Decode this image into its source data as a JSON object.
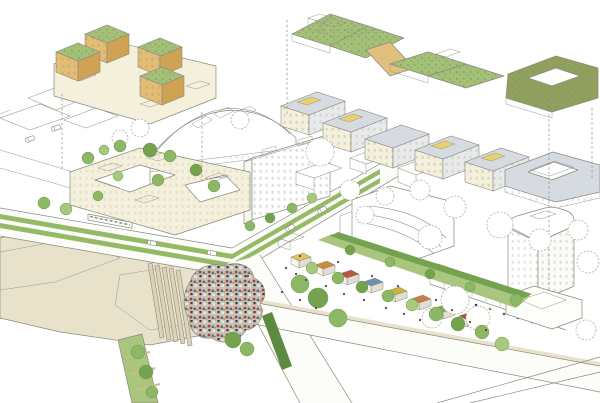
{
  "colors": {
    "paper": "#ffffff",
    "ink": "#8a8a80",
    "ink_soft": "#aeaea4",
    "beige": "#e9e2cb",
    "beige_soft": "#f4efe0",
    "road": "#fcfcf9",
    "grass": "#a9c57e",
    "tram_grass": "#95ba66",
    "tree": "#8cb765",
    "tree_dark": "#74a24e",
    "tree_light": "#a6c87f",
    "hedge": "#5d8a43",
    "roof_green": "#a2c077",
    "roof_olive": "#8fa05f",
    "cream": "#f5f0dc",
    "tan": "#cfa254",
    "tan_light": "#e3bd74",
    "tan_ramp": "#e0c07c",
    "yellow": "#e9cf6e",
    "gray_roof": "#d5dbe0",
    "gray_face": "#e8eaea",
    "glass": "#cfe2c9",
    "pool": "#cde1e8",
    "pond": "#eef3f2",
    "canopy_base": "#c9c3b6",
    "canopy_red": "#9f4439",
    "canopy_blue": "#4e6e92",
    "canopy_navy": "#2f3d55",
    "canopy_light": "#e9e5da",
    "canopy_orange": "#c07840",
    "tram_body": "#fbfbf8",
    "figure": "#4a4a44",
    "stall_colors": [
      "#e5c35c",
      "#cf8a3e",
      "#b85643",
      "#6d8fae",
      "#c9b23f",
      "#c77b47",
      "#87a457",
      "#b0563f"
    ],
    "crowd_colors": [
      "#9f4439",
      "#4e6e92",
      "#2f3d55",
      "#c07840"
    ]
  },
  "trees": [
    {
      "x": 88,
      "y": 158,
      "r": 6,
      "tone": "tree"
    },
    {
      "x": 104,
      "y": 150,
      "r": 5,
      "tone": "tree_light"
    },
    {
      "x": 120,
      "y": 146,
      "r": 6,
      "tone": "tree"
    },
    {
      "x": 150,
      "y": 150,
      "r": 7,
      "tone": "tree_dark"
    },
    {
      "x": 170,
      "y": 156,
      "r": 6,
      "tone": "tree"
    },
    {
      "x": 118,
      "y": 176,
      "r": 5,
      "tone": "tree_light"
    },
    {
      "x": 158,
      "y": 180,
      "r": 6,
      "tone": "tree"
    },
    {
      "x": 196,
      "y": 170,
      "r": 6,
      "tone": "tree_dark"
    },
    {
      "x": 214,
      "y": 186,
      "r": 6,
      "tone": "tree"
    },
    {
      "x": 98,
      "y": 196,
      "r": 5,
      "tone": "tree"
    },
    {
      "x": 44,
      "y": 203,
      "r": 6,
      "tone": "tree"
    },
    {
      "x": 66,
      "y": 209,
      "r": 6,
      "tone": "tree_light"
    },
    {
      "x": 250,
      "y": 226,
      "r": 5,
      "tone": "tree"
    },
    {
      "x": 270,
      "y": 218,
      "r": 5,
      "tone": "tree_dark"
    },
    {
      "x": 292,
      "y": 208,
      "r": 5,
      "tone": "tree"
    },
    {
      "x": 312,
      "y": 198,
      "r": 5,
      "tone": "tree_light"
    },
    {
      "x": 138,
      "y": 352,
      "r": 7,
      "tone": "tree"
    },
    {
      "x": 146,
      "y": 372,
      "r": 7,
      "tone": "tree_dark"
    },
    {
      "x": 152,
      "y": 392,
      "r": 6,
      "tone": "tree"
    },
    {
      "x": 233,
      "y": 340,
      "r": 8,
      "tone": "tree_dark"
    },
    {
      "x": 247,
      "y": 349,
      "r": 7,
      "tone": "tree"
    },
    {
      "x": 300,
      "y": 284,
      "r": 9,
      "tone": "tree"
    },
    {
      "x": 318,
      "y": 298,
      "r": 10,
      "tone": "tree_dark"
    },
    {
      "x": 338,
      "y": 318,
      "r": 9,
      "tone": "tree"
    },
    {
      "x": 312,
      "y": 268,
      "r": 6,
      "tone": "tree_light"
    },
    {
      "x": 338,
      "y": 278,
      "r": 6,
      "tone": "tree"
    },
    {
      "x": 362,
      "y": 287,
      "r": 6,
      "tone": "tree_dark"
    },
    {
      "x": 388,
      "y": 296,
      "r": 6,
      "tone": "tree"
    },
    {
      "x": 412,
      "y": 305,
      "r": 6,
      "tone": "tree_light"
    },
    {
      "x": 436,
      "y": 314,
      "r": 7,
      "tone": "tree"
    },
    {
      "x": 458,
      "y": 324,
      "r": 7,
      "tone": "tree_dark"
    },
    {
      "x": 482,
      "y": 332,
      "r": 7,
      "tone": "tree"
    },
    {
      "x": 350,
      "y": 250,
      "r": 5,
      "tone": "tree_dark"
    },
    {
      "x": 390,
      "y": 262,
      "r": 5,
      "tone": "tree"
    },
    {
      "x": 430,
      "y": 274,
      "r": 5,
      "tone": "tree_dark"
    },
    {
      "x": 470,
      "y": 287,
      "r": 5,
      "tone": "tree"
    },
    {
      "x": 502,
      "y": 344,
      "r": 7,
      "tone": "tree_light"
    },
    {
      "x": 516,
      "y": 300,
      "r": 6,
      "tone": "tree"
    }
  ],
  "sketch_trees": [
    {
      "x": 140,
      "y": 128,
      "r": 9
    },
    {
      "x": 120,
      "y": 138,
      "r": 8
    },
    {
      "x": 240,
      "y": 120,
      "r": 9
    },
    {
      "x": 320,
      "y": 152,
      "r": 14
    },
    {
      "x": 350,
      "y": 190,
      "r": 10
    },
    {
      "x": 385,
      "y": 196,
      "r": 9
    },
    {
      "x": 420,
      "y": 190,
      "r": 10
    },
    {
      "x": 455,
      "y": 207,
      "r": 11
    },
    {
      "x": 365,
      "y": 215,
      "r": 9
    },
    {
      "x": 430,
      "y": 237,
      "r": 12
    },
    {
      "x": 455,
      "y": 300,
      "r": 14
    },
    {
      "x": 432,
      "y": 318,
      "r": 10
    },
    {
      "x": 478,
      "y": 318,
      "r": 12
    },
    {
      "x": 500,
      "y": 225,
      "r": 13
    },
    {
      "x": 540,
      "y": 240,
      "r": 11
    },
    {
      "x": 578,
      "y": 230,
      "r": 10
    },
    {
      "x": 588,
      "y": 262,
      "r": 11
    },
    {
      "x": 586,
      "y": 330,
      "r": 10
    }
  ],
  "leader_lines": [
    {
      "x1": 62,
      "y1": 94,
      "x2": 62,
      "y2": 170
    },
    {
      "x1": 202,
      "y1": 112,
      "x2": 202,
      "y2": 182
    },
    {
      "x1": 287,
      "y1": 20,
      "x2": 287,
      "y2": 114
    },
    {
      "x1": 549,
      "y1": 100,
      "x2": 549,
      "y2": 290
    },
    {
      "x1": 592,
      "y1": 108,
      "x2": 592,
      "y2": 180
    }
  ],
  "garden_strips": [
    "148,264 152,263 164,337 160,338",
    "155,266 159,265 171,339 167,340",
    "162,268 166,267 178,341 174,342",
    "169,269 173,268 185,343 181,344",
    "176,271 180,270 192,345 188,346"
  ],
  "median_stripes": [
    {
      "x1": 126,
      "y1": 358,
      "x2": 150,
      "y2": 352
    },
    {
      "x1": 131,
      "y1": 374,
      "x2": 155,
      "y2": 368
    },
    {
      "x1": 136,
      "y1": 390,
      "x2": 160,
      "y2": 384
    }
  ],
  "stalls": [
    {
      "x": 300,
      "y": 258,
      "c": 0
    },
    {
      "x": 324,
      "y": 266,
      "c": 1
    },
    {
      "x": 348,
      "y": 275,
      "c": 2
    },
    {
      "x": 372,
      "y": 283,
      "c": 3
    },
    {
      "x": 396,
      "y": 292,
      "c": 4
    },
    {
      "x": 420,
      "y": 300,
      "c": 5
    },
    {
      "x": 444,
      "y": 309,
      "c": 6
    },
    {
      "x": 468,
      "y": 317,
      "c": 7
    }
  ],
  "vehicles": {
    "tram": {
      "x": 88,
      "y": 214,
      "len": 44,
      "slope": 0.19,
      "h": 6
    },
    "cars": [
      {
        "x": 152,
        "y": 243,
        "a": 10
      },
      {
        "x": 212,
        "y": 253,
        "a": 10
      },
      {
        "x": 290,
        "y": 228,
        "a": -30
      },
      {
        "x": 322,
        "y": 210,
        "a": -30
      },
      {
        "x": 30,
        "y": 139,
        "a": -20
      },
      {
        "x": 56,
        "y": 128,
        "a": -20
      }
    ]
  },
  "figures": [
    [
      286,
      268
    ],
    [
      296,
      274
    ],
    [
      306,
      280
    ],
    [
      326,
      286
    ],
    [
      344,
      294
    ],
    [
      364,
      300
    ],
    [
      386,
      308
    ],
    [
      404,
      314
    ],
    [
      420,
      320
    ],
    [
      300,
      256
    ],
    [
      338,
      262
    ],
    [
      372,
      276
    ],
    [
      398,
      286
    ],
    [
      436,
      300
    ],
    [
      452,
      310
    ],
    [
      470,
      322
    ],
    [
      486,
      330
    ],
    [
      300,
      300
    ],
    [
      316,
      308
    ],
    [
      282,
      292
    ],
    [
      262,
      286
    ],
    [
      248,
      276
    ]
  ],
  "crowd": [
    [
      448,
      296
    ],
    [
      462,
      300
    ],
    [
      476,
      305
    ],
    [
      490,
      309
    ],
    [
      504,
      314
    ],
    [
      518,
      318
    ],
    [
      532,
      322
    ],
    [
      546,
      326
    ]
  ]
}
